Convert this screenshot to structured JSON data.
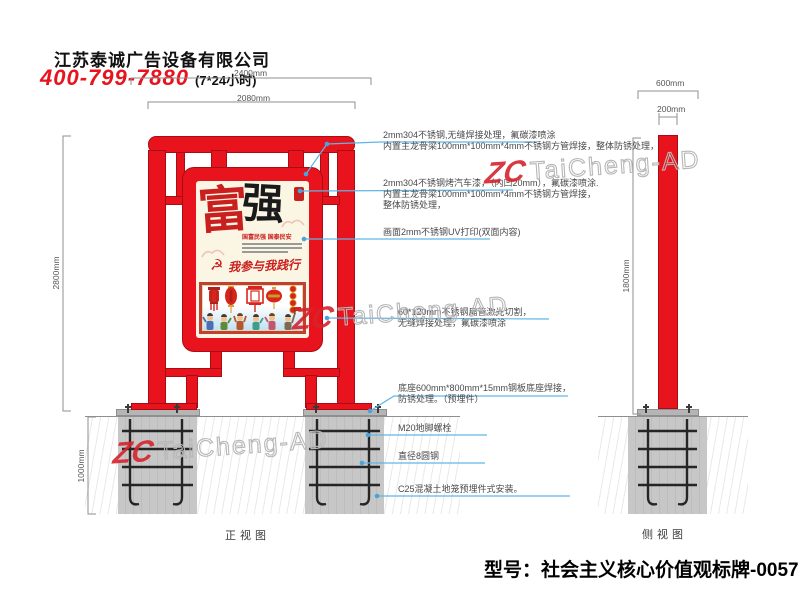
{
  "header": {
    "company": "江苏泰诚广告设备有限公司",
    "phone": "400-799-7880",
    "hours": "(7*24小时)"
  },
  "front_view": {
    "label": "正视图",
    "dim_total": "2400mm",
    "dim_width": "2080mm",
    "dim_height": "2800mm",
    "dim_foundation": "1000mm"
  },
  "side_view": {
    "label": "侧视图",
    "dim_base": "600mm",
    "dim_pole_width": "200mm",
    "dim_pole_height": "1800mm"
  },
  "poster": {
    "char_left": "富",
    "char_right": "强",
    "subtitle": "国富民强 国泰民安",
    "emblem_icon": "☭",
    "slogan": "我参与我践行"
  },
  "annotations": [
    {
      "lines": [
        "2mm304不锈钢,无缝焊接处理，氟碳漆喷涂",
        "内置主龙骨梁100mm*100mm*4mm不锈钢方管焊接，整体防锈处理，"
      ]
    },
    {
      "lines": [
        "2mm304不锈钢烤汽车漆，（内凹20mm），氟碳漆喷涂.",
        "内置主龙骨梁100mm*100mm*4mm不锈钢方管焊接，",
        "整体防锈处理，"
      ]
    },
    {
      "lines": [
        "画面2mm不锈钢UV打印(双面内容)"
      ]
    },
    {
      "lines": [
        "60*120mm不锈钢扁管激光切割，",
        "无缝焊接处理，氟碳漆喷涂"
      ]
    },
    {
      "lines": [
        "底座600mm*800mm*15mm钢板底座焊接，",
        "防锈处理。（预埋件）"
      ]
    },
    {
      "lines": [
        "M20地脚螺栓"
      ]
    },
    {
      "lines": [
        "直径8圆钢"
      ]
    },
    {
      "lines": [
        "C25混凝土地笼预埋件式安装。"
      ]
    }
  ],
  "watermark": {
    "logo": "ZC",
    "text": "TaiCheng-AD"
  },
  "model_label": "型号：社会主义核心价值观标牌-0057",
  "colors": {
    "accent_red": "#e8131c",
    "leader_blue": "#5fb6e5",
    "dim_gray": "#8f8f8f"
  }
}
